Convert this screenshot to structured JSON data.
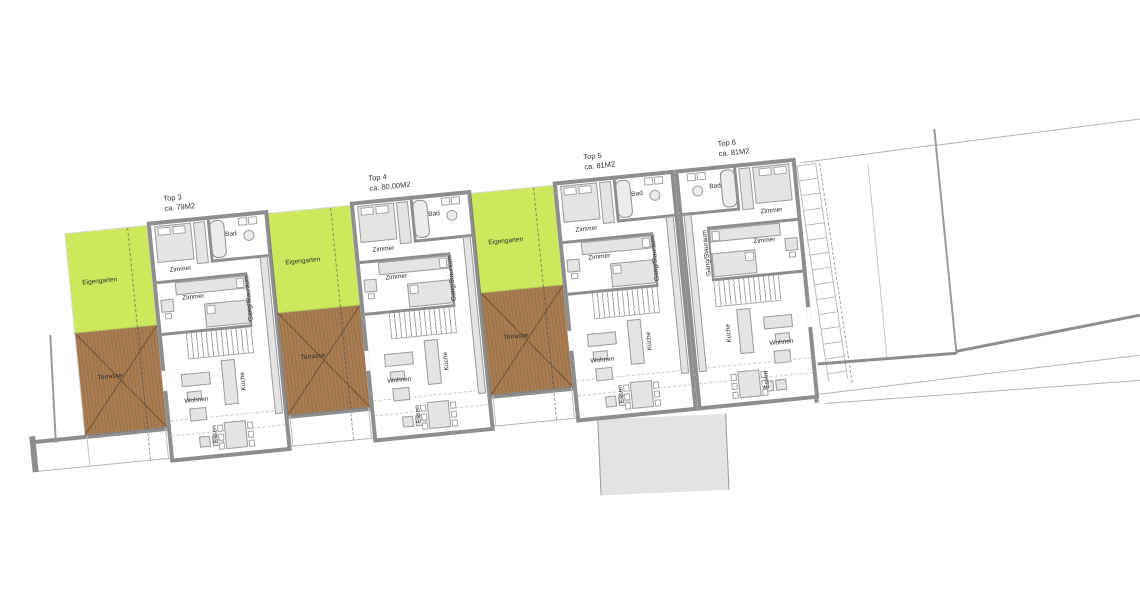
{
  "plan": {
    "units": [
      {
        "name": "Top 3",
        "area": "ca. 79M2",
        "mirrored": false,
        "garden": true
      },
      {
        "name": "Top 4",
        "area": "ca. 80,00M2",
        "mirrored": false,
        "garden": true
      },
      {
        "name": "Top 5",
        "area": "ca. 81M2",
        "mirrored": false,
        "garden": true
      },
      {
        "name": "Top 6",
        "area": "ca. 81M2",
        "mirrored": true,
        "garden": false
      }
    ],
    "room_labels": {
      "bedroom": "Zimmer",
      "bath": "Bad",
      "hallway": "Gang/Stauraum",
      "living": "Wohnen",
      "kitchen": "Küche",
      "dining": "Essen",
      "garden": "Eigengarten",
      "terrace": "Terrasse"
    },
    "colors": {
      "garden": "#cde85c",
      "terrace": "#a97d51",
      "wall": "#8e8e8e",
      "furniture": "#e4e4e4",
      "driveway": "#e3e3e3"
    }
  }
}
